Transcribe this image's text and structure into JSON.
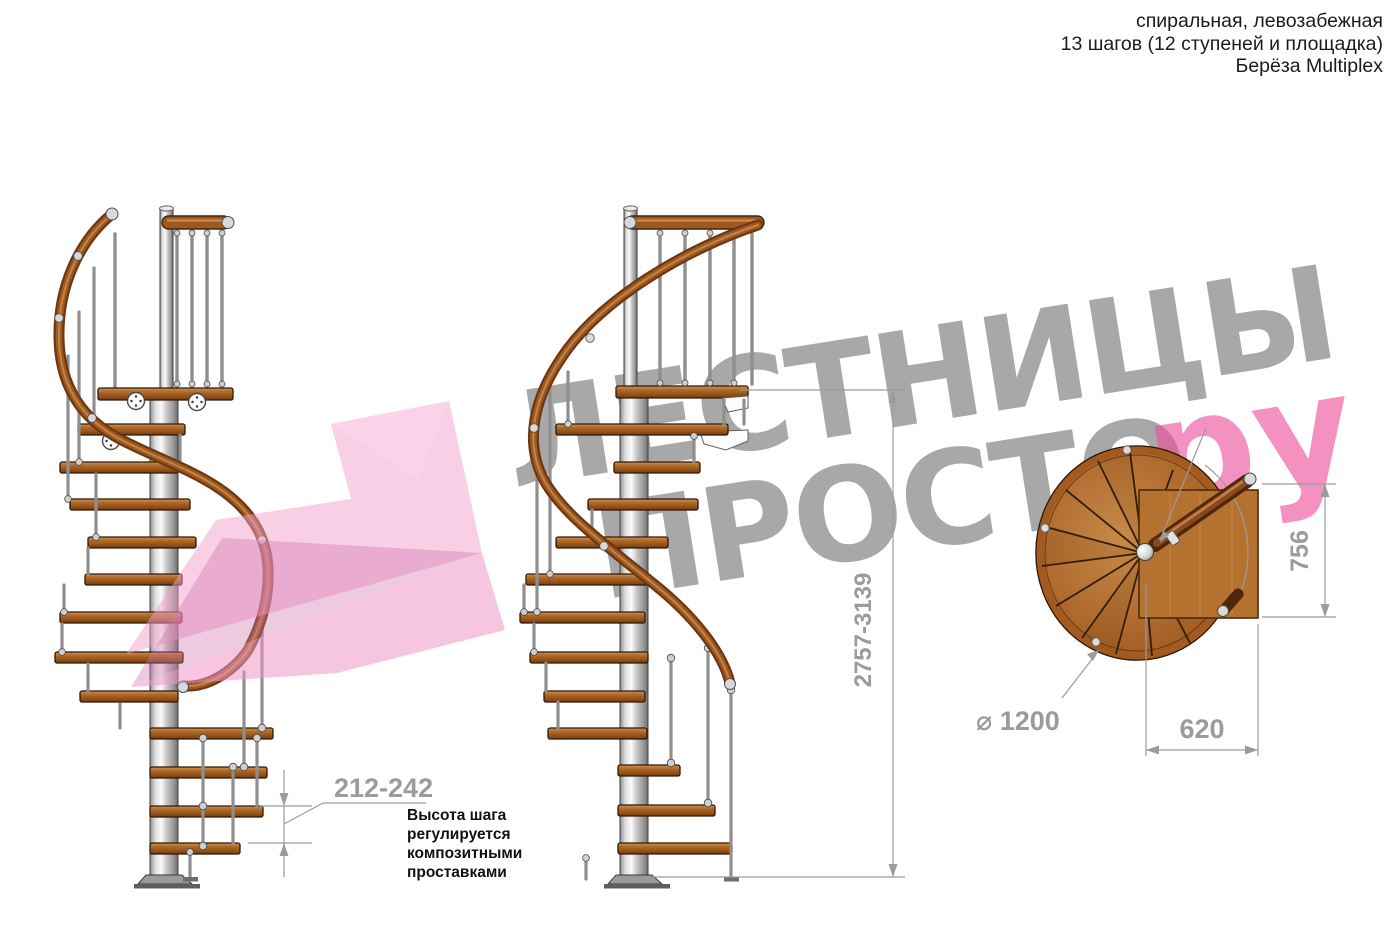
{
  "header": {
    "lines": [
      "спиральная, левозабежная",
      "13 шагов (12 ступеней и площадка)",
      "Берёза Multiplex"
    ]
  },
  "watermark": {
    "line1": "ЛЕСТНИЦЫ",
    "line2": "ПРОСТО",
    "suffix": ".ру",
    "gray_color": "#a8a8a8",
    "pink_color": "#ec4d9b"
  },
  "dimensions": {
    "step_height": "212-242",
    "total_height": "2757-3139",
    "landing_depth": "756",
    "landing_width": "620",
    "diameter": "⌀ 1200"
  },
  "annotation": {
    "lines": [
      "Высота шага",
      "регулируется",
      "композитными",
      "проставками"
    ]
  },
  "colors": {
    "wood": "#b26c2a",
    "rail": "#9c5a22",
    "pole": "#c9c9c9",
    "dimension_gray": "#9b9b9b",
    "facet_pink": "#f1a0cc"
  }
}
